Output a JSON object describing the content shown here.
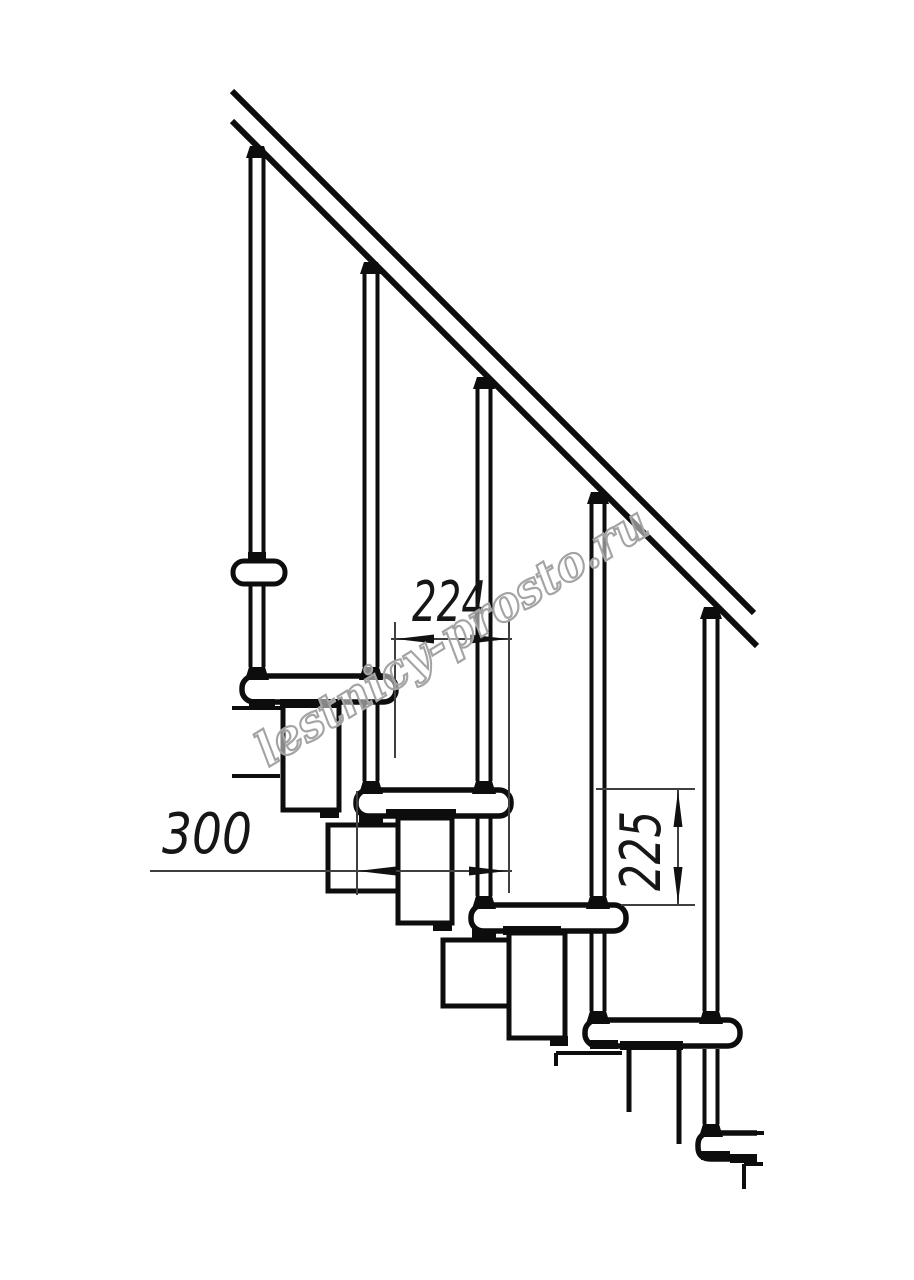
{
  "drawing": {
    "watermark": "lestnicy-prosto.ru",
    "dimensions": {
      "step_offset_mm": "224",
      "tread_depth_mm": "300",
      "rise_mm": "225"
    }
  },
  "colors": {
    "line": "#0d0d0d",
    "dimension_line": "#3f3f3f",
    "dimension_text": "#161616",
    "watermark_outline": "#a4a4a4",
    "background": "#ffffff"
  }
}
